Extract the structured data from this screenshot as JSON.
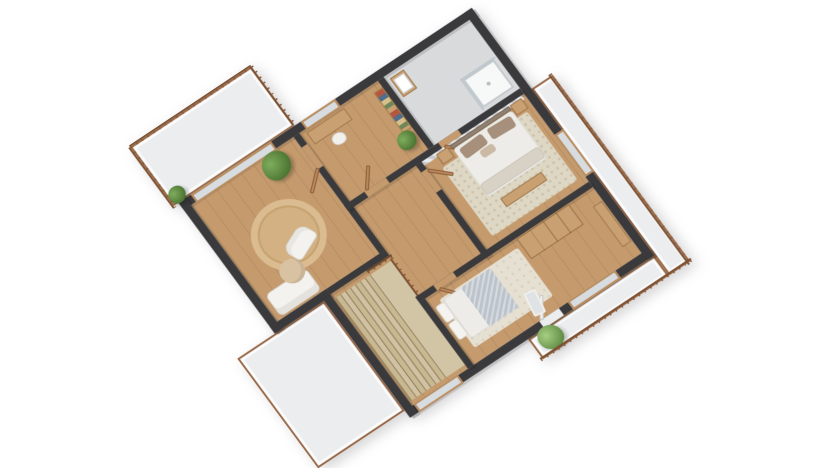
{
  "meta": {
    "description": "3D isometric rendering of an upper-storey house floor plan, no visible text",
    "canvas": {
      "width": 832,
      "height": 468
    },
    "background_color": "#ffffff"
  },
  "palette": {
    "wall_top": "#3a3a3c",
    "wood_floor": "#c59b6e",
    "bath_floor": "#d9dadc",
    "deck_floor": "#ecedef",
    "deck_trim": "#9a6a49",
    "furniture_wood": "#c8a072",
    "door_wood": "#b98a5f",
    "rug_beige": "#d8b88c",
    "rug_cream": "#ded7c4",
    "duvet_white": "#edece8",
    "pillow_taupe": "#a68f7b",
    "plant_green": "#49702f",
    "stair_tread": "#cbbd9c"
  },
  "scene": {
    "transform": "translate(191px, 205px) scale(1, 0.95) rotate(-35deg)",
    "rooms": [
      "balcony-north",
      "deck-southwest",
      "balcony-east",
      "balcony-south",
      "living-room",
      "office",
      "bathroom",
      "hallway",
      "master-bedroom",
      "bedroom",
      "staircase"
    ],
    "elements": [
      {
        "name": "balcony-north-floor",
        "kind": "deck",
        "x": -15,
        "y": -85,
        "w": 148,
        "h": 76
      },
      {
        "name": "deck-southwest-floor",
        "kind": "deck",
        "x": -55,
        "y": 159,
        "w": 106,
        "h": 141
      },
      {
        "name": "balcony-east-floor",
        "kind": "deck",
        "x": 349,
        "y": 95,
        "w": 26,
        "h": 240
      },
      {
        "name": "balcony-south-floor",
        "kind": "deck",
        "x": 195,
        "y": 309,
        "w": 154,
        "h": 26
      },
      {
        "name": "living-room-floor",
        "kind": "floor-wood",
        "x": 0,
        "y": 0,
        "w": 125,
        "h": 150
      },
      {
        "name": "office-floor",
        "kind": "floor-wood",
        "x": 132,
        "y": 0,
        "w": 96,
        "h": 88
      },
      {
        "name": "bathroom-floor",
        "kind": "floor-bath",
        "x": 235,
        "y": 0,
        "w": 105,
        "h": 88
      },
      {
        "name": "hallway-floor",
        "kind": "floor-wood",
        "x": 125,
        "y": 88,
        "w": 90,
        "h": 127
      },
      {
        "name": "master-bedroom-floor",
        "kind": "floor-wood",
        "x": 215,
        "y": 95,
        "w": 125,
        "h": 113
      },
      {
        "name": "bedroom-floor",
        "kind": "floor-wood",
        "x": 135,
        "y": 208,
        "w": 205,
        "h": 92
      },
      {
        "name": "staircase-base-floor",
        "kind": "floor-wood",
        "x": 60,
        "y": 150,
        "w": 72,
        "h": 150
      },
      {
        "name": "living-round-rug",
        "kind": "rug-round",
        "x": 24,
        "y": 44,
        "w": 76,
        "h": 76
      },
      {
        "name": "master-rug",
        "kind": "rug",
        "x": 228,
        "y": 112,
        "w": 104,
        "h": 88
      },
      {
        "name": "bedroom-rug",
        "kind": "rug-light",
        "x": 146,
        "y": 224,
        "w": 96,
        "h": 62
      },
      {
        "name": "stair-landing",
        "kind": "tread",
        "x": 104,
        "y": 163,
        "w": 26,
        "h": 132,
        "color": "#d2c5a5"
      },
      {
        "name": "stair-tread",
        "kind": "tread",
        "x": 62,
        "y": 163,
        "w": 6,
        "h": 132,
        "color": "#c9b992"
      },
      {
        "name": "stair-tread",
        "kind": "tread",
        "x": 68,
        "y": 163,
        "w": 6,
        "h": 132,
        "color": "#d0c2a2"
      },
      {
        "name": "stair-tread",
        "kind": "tread",
        "x": 74,
        "y": 163,
        "w": 6,
        "h": 132,
        "color": "#c9b992"
      },
      {
        "name": "stair-tread",
        "kind": "tread",
        "x": 80,
        "y": 163,
        "w": 6,
        "h": 132,
        "color": "#d0c2a2"
      },
      {
        "name": "stair-tread",
        "kind": "tread",
        "x": 86,
        "y": 163,
        "w": 6,
        "h": 132,
        "color": "#c9b992"
      },
      {
        "name": "stair-tread",
        "kind": "tread",
        "x": 92,
        "y": 163,
        "w": 6,
        "h": 132,
        "color": "#d0c2a2"
      },
      {
        "name": "stair-tread",
        "kind": "tread",
        "x": 98,
        "y": 163,
        "w": 6,
        "h": 132,
        "color": "#c9b992"
      },
      {
        "name": "stair-railing",
        "kind": "rail-h",
        "x": 104,
        "y": 157,
        "w": 30,
        "h": 4
      },
      {
        "name": "stair-railing-side",
        "kind": "rail-v",
        "x": 130,
        "y": 161,
        "w": 4,
        "h": 52
      },
      {
        "name": "wall-north",
        "kind": "wall",
        "x": -9,
        "y": -9,
        "w": 358,
        "h": 9
      },
      {
        "name": "wall-east",
        "kind": "wall",
        "x": 340,
        "y": -9,
        "w": 9,
        "h": 318
      },
      {
        "name": "wall-south",
        "kind": "wall",
        "x": 51,
        "y": 300,
        "w": 298,
        "h": 9
      },
      {
        "name": "wall-west",
        "kind": "wall",
        "x": -9,
        "y": -9,
        "w": 9,
        "h": 168
      },
      {
        "name": "wall-southwest",
        "kind": "wall",
        "x": -9,
        "y": 150,
        "w": 69,
        "h": 9
      },
      {
        "name": "wall-stairs-west",
        "kind": "wall",
        "x": 51,
        "y": 150,
        "w": 9,
        "h": 159
      },
      {
        "name": "wall-living-east",
        "kind": "wall",
        "x": 125,
        "y": 0,
        "w": 7,
        "h": 150
      },
      {
        "name": "wall-living-south",
        "kind": "wall",
        "x": 60,
        "y": 150,
        "w": 72,
        "h": 7
      },
      {
        "name": "wall-office-east",
        "kind": "wall",
        "x": 228,
        "y": 0,
        "w": 7,
        "h": 88
      },
      {
        "name": "wall-mid-horizontal",
        "kind": "wall",
        "x": 125,
        "y": 88,
        "w": 215,
        "h": 7
      },
      {
        "name": "wall-master-west",
        "kind": "wall",
        "x": 208,
        "y": 95,
        "w": 7,
        "h": 120
      },
      {
        "name": "wall-bedroom-north",
        "kind": "wall",
        "x": 128,
        "y": 208,
        "w": 212,
        "h": 7
      },
      {
        "name": "wall-bedroom-west",
        "kind": "wall",
        "x": 128,
        "y": 215,
        "w": 7,
        "h": 85
      },
      {
        "name": "master-accent-wall",
        "kind": "accent",
        "x": 215,
        "y": 95,
        "w": 122,
        "h": 5
      },
      {
        "name": "doorway-living",
        "kind": "gap-wood",
        "x": 125,
        "y": 14,
        "w": 7,
        "h": 28
      },
      {
        "name": "doorway-office",
        "kind": "gap-wood",
        "x": 150,
        "y": 88,
        "w": 26,
        "h": 7
      },
      {
        "name": "doorway-bathroom",
        "kind": "gap-wood",
        "x": 240,
        "y": 88,
        "w": 24,
        "h": 7
      },
      {
        "name": "doorway-master",
        "kind": "gap-wood",
        "x": 208,
        "y": 104,
        "w": 7,
        "h": 26
      },
      {
        "name": "doorway-bedroom",
        "kind": "gap-wood",
        "x": 150,
        "y": 208,
        "w": 24,
        "h": 7
      },
      {
        "name": "doorway-bedroom-south",
        "kind": "gap-deck",
        "x": 215,
        "y": 300,
        "w": 24,
        "h": 9
      },
      {
        "name": "window-living-north",
        "kind": "window",
        "x": 6,
        "y": -9,
        "w": 98,
        "h": 11
      },
      {
        "name": "window-office-north",
        "kind": "window",
        "x": 140,
        "y": -9,
        "w": 42,
        "h": 11
      },
      {
        "name": "window-master-east",
        "kind": "window",
        "x": 340,
        "y": 148,
        "w": 11,
        "h": 54
      },
      {
        "name": "window-bedroom-south",
        "kind": "window",
        "x": 250,
        "y": 299,
        "w": 58,
        "h": 11
      },
      {
        "name": "window-stairs-south",
        "kind": "window",
        "x": 62,
        "y": 299,
        "w": 54,
        "h": 11
      },
      {
        "name": "door-living",
        "kind": "door",
        "x": 99,
        "y": 39,
        "w": 27,
        "h": 3.5,
        "rot": -42,
        "origin": "100% 50%"
      },
      {
        "name": "door-office",
        "kind": "door",
        "x": 151,
        "y": 62,
        "w": 3.5,
        "h": 26,
        "rot": 38,
        "origin": "50% 100%"
      },
      {
        "name": "door-bathroom",
        "kind": "door",
        "x": 241,
        "y": 95,
        "w": 3.5,
        "h": 26,
        "rot": -48,
        "origin": "50% 0%"
      },
      {
        "name": "door-master",
        "kind": "door",
        "x": 215,
        "y": 104,
        "w": 26,
        "h": 3.5,
        "rot": 44,
        "origin": "0% 50%"
      },
      {
        "name": "door-bedroom",
        "kind": "door",
        "x": 151,
        "y": 215,
        "w": 3.5,
        "h": 26,
        "rot": -40,
        "origin": "50% 0%"
      },
      {
        "name": "door-bedroom-south",
        "kind": "door-white",
        "x": 216,
        "y": 274,
        "w": 3.5,
        "h": 26,
        "rot": 34,
        "origin": "50% 100%"
      },
      {
        "name": "office-desk",
        "kind": "wood",
        "x": 138,
        "y": 4,
        "w": 46,
        "h": 15
      },
      {
        "name": "office-chair",
        "kind": "chair",
        "x": 154,
        "y": 21,
        "w": 15,
        "h": 13,
        "rot": 8
      },
      {
        "name": "office-bookshelf",
        "kind": "shelf",
        "x": 217,
        "y": 8,
        "w": 11,
        "h": 52
      },
      {
        "name": "office-plant-pot",
        "kind": "pot",
        "x": 213,
        "y": 69,
        "w": 9,
        "h": 8
      },
      {
        "name": "office-plant",
        "kind": "plant",
        "x": 206,
        "y": 58,
        "w": 20,
        "h": 20
      },
      {
        "name": "bath-sink-cabinet",
        "kind": "wood",
        "x": 239,
        "y": 5,
        "w": 17,
        "h": 24
      },
      {
        "name": "bath-sink-basin",
        "kind": "basin",
        "x": 241,
        "y": 8,
        "w": 13,
        "h": 18
      },
      {
        "name": "shower-tray",
        "kind": "shower",
        "x": 298,
        "y": 48,
        "w": 38,
        "h": 36
      },
      {
        "name": "shower-drain",
        "kind": "pot",
        "x": 315,
        "y": 64,
        "w": 4,
        "h": 4,
        "color": "#b9bec1"
      },
      {
        "name": "shower-glass-top",
        "kind": "glassline",
        "x": 296,
        "y": 46,
        "w": 42,
        "h": 2
      },
      {
        "name": "shower-glass-side",
        "kind": "glassline",
        "x": 296,
        "y": 46,
        "w": 2,
        "h": 40
      },
      {
        "name": "master-headboard",
        "kind": "wood",
        "x": 248,
        "y": 97,
        "w": 72,
        "h": 5,
        "color": "#8f8274"
      },
      {
        "name": "master-duvet",
        "kind": "duvet",
        "x": 248,
        "y": 102,
        "w": 72,
        "h": 62
      },
      {
        "name": "master-pillow-left",
        "kind": "pillow",
        "x": 253,
        "y": 105,
        "w": 28,
        "h": 13,
        "rot": -3
      },
      {
        "name": "master-pillow-right",
        "kind": "pillow",
        "x": 287,
        "y": 105,
        "w": 28,
        "h": 13,
        "rot": 3
      },
      {
        "name": "master-cushion",
        "kind": "pillow",
        "x": 268,
        "y": 119,
        "w": 16,
        "h": 9,
        "color": "#cbb9a6"
      },
      {
        "name": "master-foot-throw",
        "kind": "duvet",
        "x": 248,
        "y": 148,
        "w": 72,
        "h": 14,
        "color": "#d8d2c6"
      },
      {
        "name": "master-nightstand-left",
        "kind": "wood",
        "x": 231,
        "y": 97,
        "w": 14,
        "h": 13
      },
      {
        "name": "master-nightstand-right",
        "kind": "wood",
        "x": 321,
        "y": 97,
        "w": 14,
        "h": 13
      },
      {
        "name": "master-bench",
        "kind": "wood",
        "x": 257,
        "y": 172,
        "w": 50,
        "h": 11
      },
      {
        "name": "bedroom-pillow-a",
        "kind": "white",
        "x": 138,
        "y": 228,
        "w": 11,
        "h": 21
      },
      {
        "name": "bedroom-pillow-b",
        "kind": "white",
        "x": 138,
        "y": 250,
        "w": 11,
        "h": 21
      },
      {
        "name": "bedroom-duvet",
        "kind": "duvet",
        "x": 149,
        "y": 226,
        "w": 58,
        "h": 50
      },
      {
        "name": "bedroom-blanket",
        "kind": "blanket",
        "x": 171,
        "y": 226,
        "w": 36,
        "h": 50
      },
      {
        "name": "bedroom-wardrobe",
        "kind": "wardrobe",
        "x": 246,
        "y": 216,
        "w": 64,
        "h": 26
      },
      {
        "name": "bedroom-sideboard",
        "kind": "wood",
        "x": 328,
        "y": 232,
        "w": 11,
        "h": 52
      },
      {
        "name": "bedroom-mirror",
        "kind": "mirror",
        "x": 216,
        "y": 268,
        "w": 13,
        "h": 27,
        "rot": 10
      },
      {
        "name": "living-sofa",
        "kind": "sofa",
        "x": 6,
        "y": 120,
        "w": 50,
        "h": 28
      },
      {
        "name": "living-pouf",
        "kind": "pouf",
        "x": 30,
        "y": 102,
        "w": 26,
        "h": 26
      },
      {
        "name": "living-chaise",
        "kind": "chaise",
        "x": 50,
        "y": 84,
        "w": 34,
        "h": 22,
        "rot": -24
      },
      {
        "name": "living-plant-pot",
        "kind": "pot",
        "x": 89,
        "y": 15,
        "w": 12,
        "h": 11
      },
      {
        "name": "living-plant",
        "kind": "plant",
        "x": 79,
        "y": 0,
        "w": 30,
        "h": 30
      },
      {
        "name": "balcony-north-plant-pot",
        "kind": "pot",
        "x": -7,
        "y": -14,
        "w": 8,
        "h": 7
      },
      {
        "name": "balcony-north-plant",
        "kind": "plant",
        "x": -14,
        "y": -26,
        "w": 18,
        "h": 18
      },
      {
        "name": "balcony-south-plant-pot",
        "kind": "pot",
        "x": 212,
        "y": 320,
        "w": 10,
        "h": 9
      },
      {
        "name": "balcony-south-plant",
        "kind": "plant-light",
        "x": 202,
        "y": 307,
        "w": 26,
        "h": 26
      },
      {
        "name": "railing-balcony-north",
        "kind": "rail-h",
        "x": -15,
        "y": -87,
        "w": 148,
        "h": 4
      },
      {
        "name": "railing-balcony-northwest",
        "kind": "rail-v",
        "x": -17,
        "y": -85,
        "w": 4,
        "h": 78
      },
      {
        "name": "railing-balcony-northeast",
        "kind": "rail-v",
        "x": 131,
        "y": -85,
        "w": 4,
        "h": 74
      },
      {
        "name": "railing-balcony-east",
        "kind": "rail-v",
        "x": 371,
        "y": 93,
        "w": 4,
        "h": 244
      },
      {
        "name": "railing-balcony-south",
        "kind": "rail-h",
        "x": 193,
        "y": 332,
        "w": 184,
        "h": 4
      }
    ]
  }
}
